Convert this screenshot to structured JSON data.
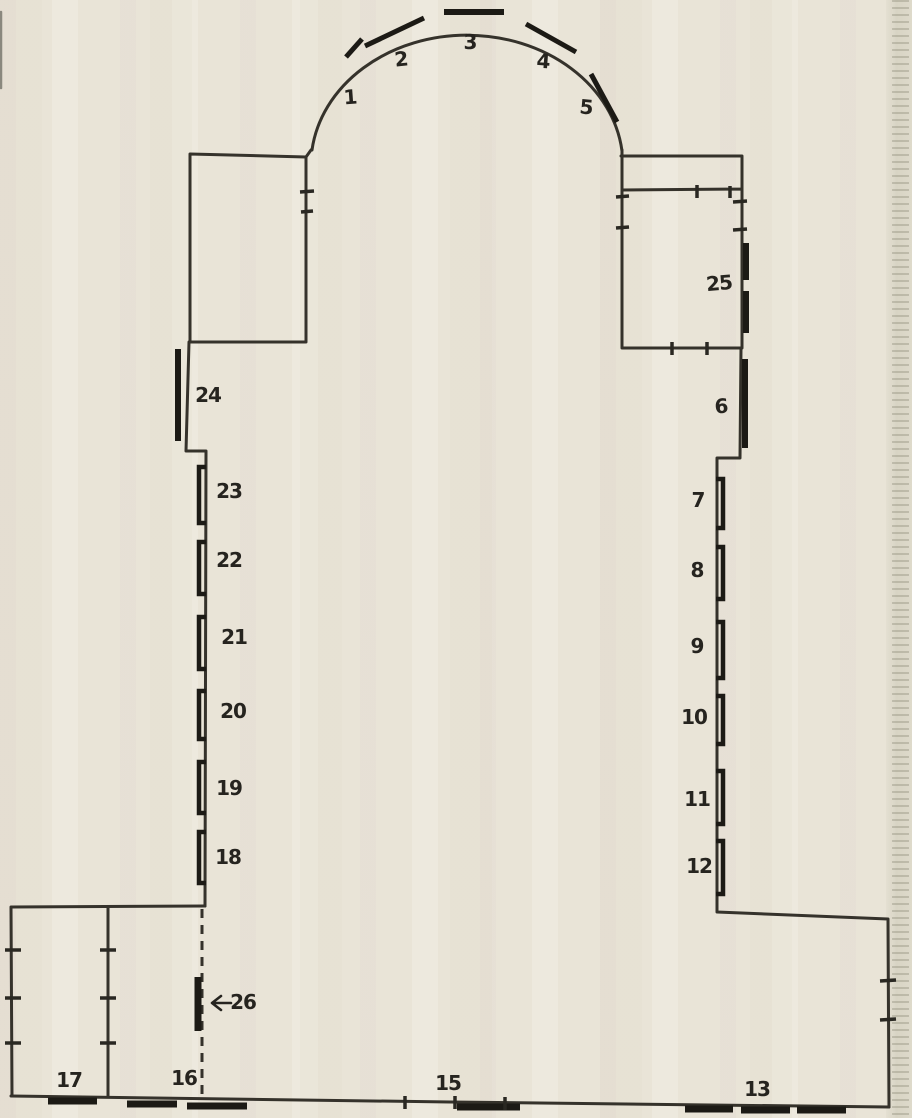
{
  "palette": {
    "paper": "#e9e4d7",
    "ink": "#35322b",
    "mark_ink": "#1c1a15",
    "edge_strip": "#d8d4c4"
  },
  "plan": {
    "labels": [
      {
        "t": "1",
        "x": 350,
        "y": 97,
        "r": -4
      },
      {
        "t": "2",
        "x": 401,
        "y": 59,
        "r": -6
      },
      {
        "t": "3",
        "x": 470,
        "y": 42,
        "r": 0
      },
      {
        "t": "4",
        "x": 543,
        "y": 61,
        "r": 4
      },
      {
        "t": "5",
        "x": 586,
        "y": 107,
        "r": 5
      },
      {
        "t": "6",
        "x": 721,
        "y": 406,
        "r": -3
      },
      {
        "t": "7",
        "x": 698,
        "y": 500,
        "r": 0
      },
      {
        "t": "8",
        "x": 697,
        "y": 570,
        "r": 0
      },
      {
        "t": "9",
        "x": 697,
        "y": 646,
        "r": 0
      },
      {
        "t": "10",
        "x": 694,
        "y": 717,
        "r": 0
      },
      {
        "t": "11",
        "x": 697,
        "y": 799,
        "r": 0
      },
      {
        "t": "12",
        "x": 699,
        "y": 866,
        "r": 0
      },
      {
        "t": "13",
        "x": 757,
        "y": 1089,
        "r": 0
      },
      {
        "t": "15",
        "x": 448,
        "y": 1083,
        "r": 0
      },
      {
        "t": "16",
        "x": 184,
        "y": 1078,
        "r": 0
      },
      {
        "t": "17",
        "x": 69,
        "y": 1080,
        "r": 0
      },
      {
        "t": "18",
        "x": 228,
        "y": 857,
        "r": 0
      },
      {
        "t": "19",
        "x": 229,
        "y": 788,
        "r": 0
      },
      {
        "t": "20",
        "x": 233,
        "y": 711,
        "r": 0
      },
      {
        "t": "21",
        "x": 234,
        "y": 637,
        "r": 0
      },
      {
        "t": "22",
        "x": 229,
        "y": 560,
        "r": 0
      },
      {
        "t": "23",
        "x": 229,
        "y": 491,
        "r": 0
      },
      {
        "t": "24",
        "x": 208,
        "y": 395,
        "r": 0
      },
      {
        "t": "25",
        "x": 719,
        "y": 283,
        "r": -5
      },
      {
        "t": "26",
        "x": 243,
        "y": 1002,
        "r": 0
      }
    ],
    "arrow_26": {
      "glyph": "←",
      "points_to": "26"
    },
    "marks": {
      "thick_segments": [
        [
          346,
          57,
          362,
          39,
          5
        ],
        [
          365,
          46,
          424,
          18,
          5
        ],
        [
          444,
          12,
          504,
          12,
          6
        ],
        [
          526,
          24,
          576,
          52,
          5
        ],
        [
          591,
          74,
          617,
          122,
          5
        ],
        [
          746,
          243,
          746,
          280,
          6
        ],
        [
          746,
          291,
          746,
          333,
          6
        ],
        [
          745,
          359,
          745,
          448,
          6
        ],
        [
          178,
          349,
          178,
          441,
          6
        ],
        [
          198,
          977,
          198,
          1031,
          7
        ],
        [
          48,
          1101,
          97,
          1101,
          7
        ],
        [
          127,
          1104,
          177,
          1104,
          7
        ],
        [
          187,
          1106,
          247,
          1106,
          7
        ],
        [
          457,
          1107,
          520,
          1107,
          7
        ],
        [
          685,
          1109,
          733,
          1109,
          7
        ],
        [
          741,
          1110,
          790,
          1110,
          7
        ],
        [
          797,
          1110,
          846,
          1110,
          7
        ]
      ],
      "ticks": [
        [
          300,
          192,
          314,
          191
        ],
        [
          301,
          212,
          313,
          211
        ],
        [
          697,
          185,
          697,
          198
        ],
        [
          730,
          186,
          730,
          198
        ],
        [
          616,
          197,
          629,
          196
        ],
        [
          616,
          228,
          629,
          227
        ],
        [
          733,
          202,
          747,
          201
        ],
        [
          733,
          230,
          747,
          229
        ],
        [
          672,
          342,
          672,
          355
        ],
        [
          707,
          342,
          707,
          355
        ],
        [
          5,
          950,
          21,
          950
        ],
        [
          5,
          998,
          21,
          998
        ],
        [
          5,
          1043,
          21,
          1043
        ],
        [
          100,
          950,
          116,
          950
        ],
        [
          100,
          998,
          116,
          998
        ],
        [
          100,
          1043,
          116,
          1043
        ],
        [
          880,
          981,
          896,
          980
        ],
        [
          880,
          1020,
          896,
          1019
        ],
        [
          405,
          1096,
          405,
          1109
        ],
        [
          455,
          1096,
          455,
          1109
        ],
        [
          505,
          1097,
          505,
          1110
        ]
      ],
      "brackets_left": {
        "x": 199,
        "cap": 206,
        "spans": [
          [
            467,
            523
          ],
          [
            542,
            594
          ],
          [
            617,
            669
          ],
          [
            691,
            739
          ],
          [
            762,
            813
          ],
          [
            832,
            883
          ]
        ]
      },
      "brackets_right": {
        "x": 723,
        "cap": 716,
        "spans": [
          [
            479,
            528
          ],
          [
            547,
            599
          ],
          [
            622,
            678
          ],
          [
            696,
            744
          ],
          [
            771,
            824
          ],
          [
            841,
            894
          ]
        ]
      }
    }
  }
}
